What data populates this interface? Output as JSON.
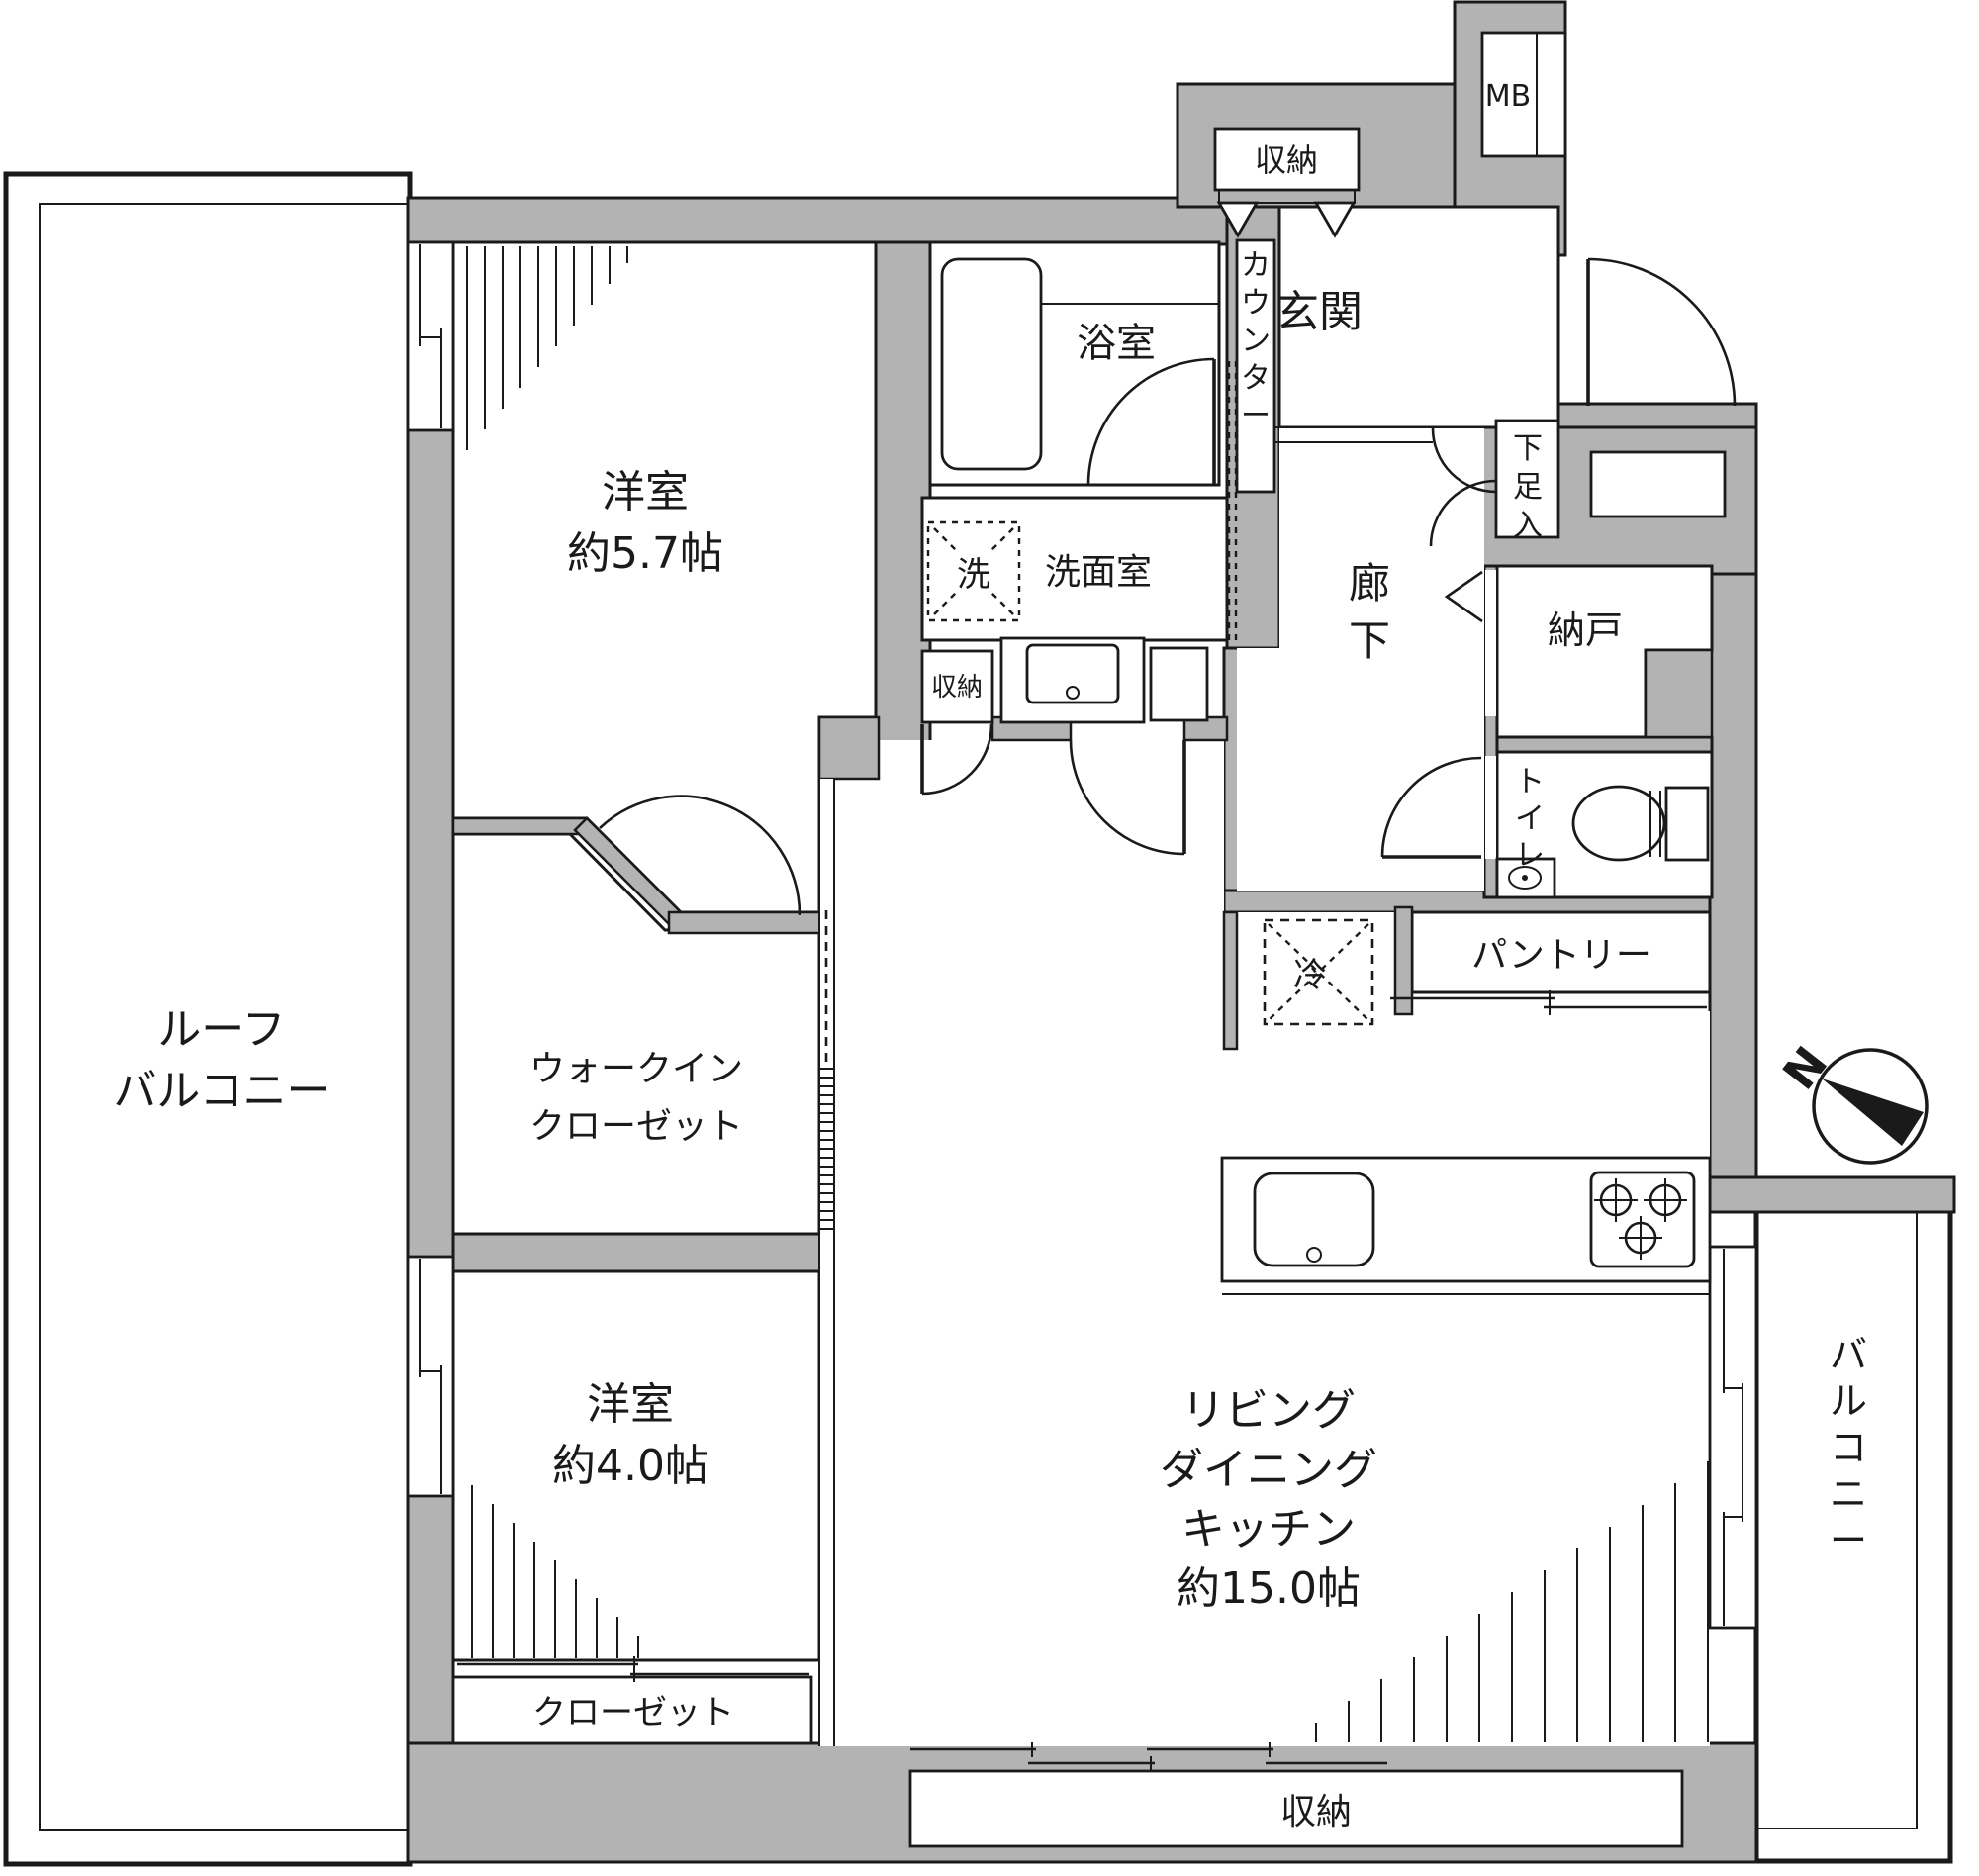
{
  "colors": {
    "wall": "#b3b3b3",
    "line": "#1a1a1a"
  },
  "labels": {
    "mb": "MB",
    "entrance_storage": "収納",
    "entrance": "玄関",
    "bathroom": "浴室",
    "counter": "カウンター",
    "washer": "洗",
    "washroom": "洗面室",
    "small_storage": "収納",
    "hallway": "廊下",
    "shoe_box": "下足入",
    "storeroom": "納戸",
    "toilet": "トイレ",
    "pantry": "パントリー",
    "fridge": "冷",
    "bedroom1_name": "洋室",
    "bedroom1_size": "約5.7帖",
    "wic_line1": "ウォークイン",
    "wic_line2": "クローゼット",
    "bedroom2_name": "洋室",
    "bedroom2_size": "約4.0帖",
    "ldk_line1": "リビング",
    "ldk_line2": "ダイニング",
    "ldk_line3": "キッチン",
    "ldk_size": "約15.0帖",
    "roof_line1": "ルーフ",
    "roof_line2": "バルコニー",
    "balcony": "バルコニー",
    "closet": "クローゼット",
    "bottom_storage": "収納",
    "north_mark": "N"
  }
}
